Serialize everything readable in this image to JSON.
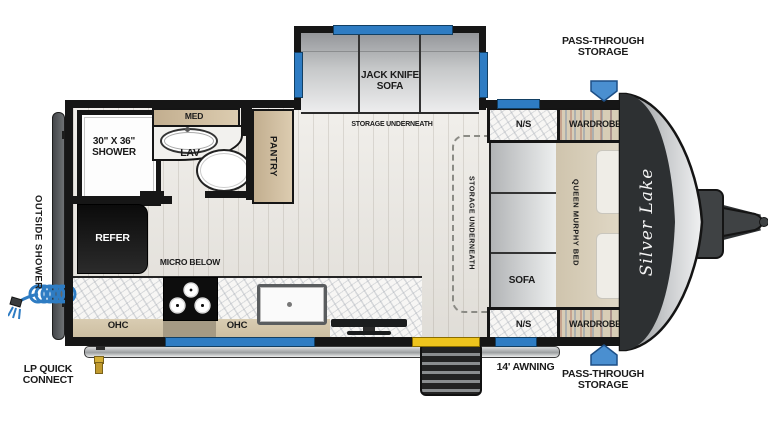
{
  "brand": "Silver Lake",
  "colors": {
    "accent_blue": "#2e7cc3",
    "accent_yellow": "#eec41d"
  },
  "exterior": {
    "pass_through_top": "PASS-THROUGH\nSTORAGE",
    "pass_through_bottom": "PASS-THROUGH\nSTORAGE",
    "awning": "14' AWNING",
    "lp_quick_connect": "LP QUICK\nCONNECT",
    "outside_shower": "OUTSIDE SHOWER"
  },
  "slideout": {
    "sofa": "JACK KNIFE\nSOFA",
    "storage": "STORAGE UNDERNEATH"
  },
  "bathroom": {
    "shower": "30\" X 36\"\nSHOWER",
    "med": "MED",
    "lav": "LAV",
    "pantry": "PANTRY"
  },
  "kitchen": {
    "refer": "REFER",
    "micro": "MICRO BELOW",
    "ohc_left": "OHC",
    "ohc_right": "OHC"
  },
  "bedroom": {
    "ns_top": "N/S",
    "ns_bottom": "N/S",
    "wardrobe_top": "WARDROBE",
    "wardrobe_bottom": "WARDROBE",
    "sofa": "SOFA",
    "bed": "QUEEN MURPHY BED",
    "storage": "STORAGE UNDERNEATH"
  }
}
